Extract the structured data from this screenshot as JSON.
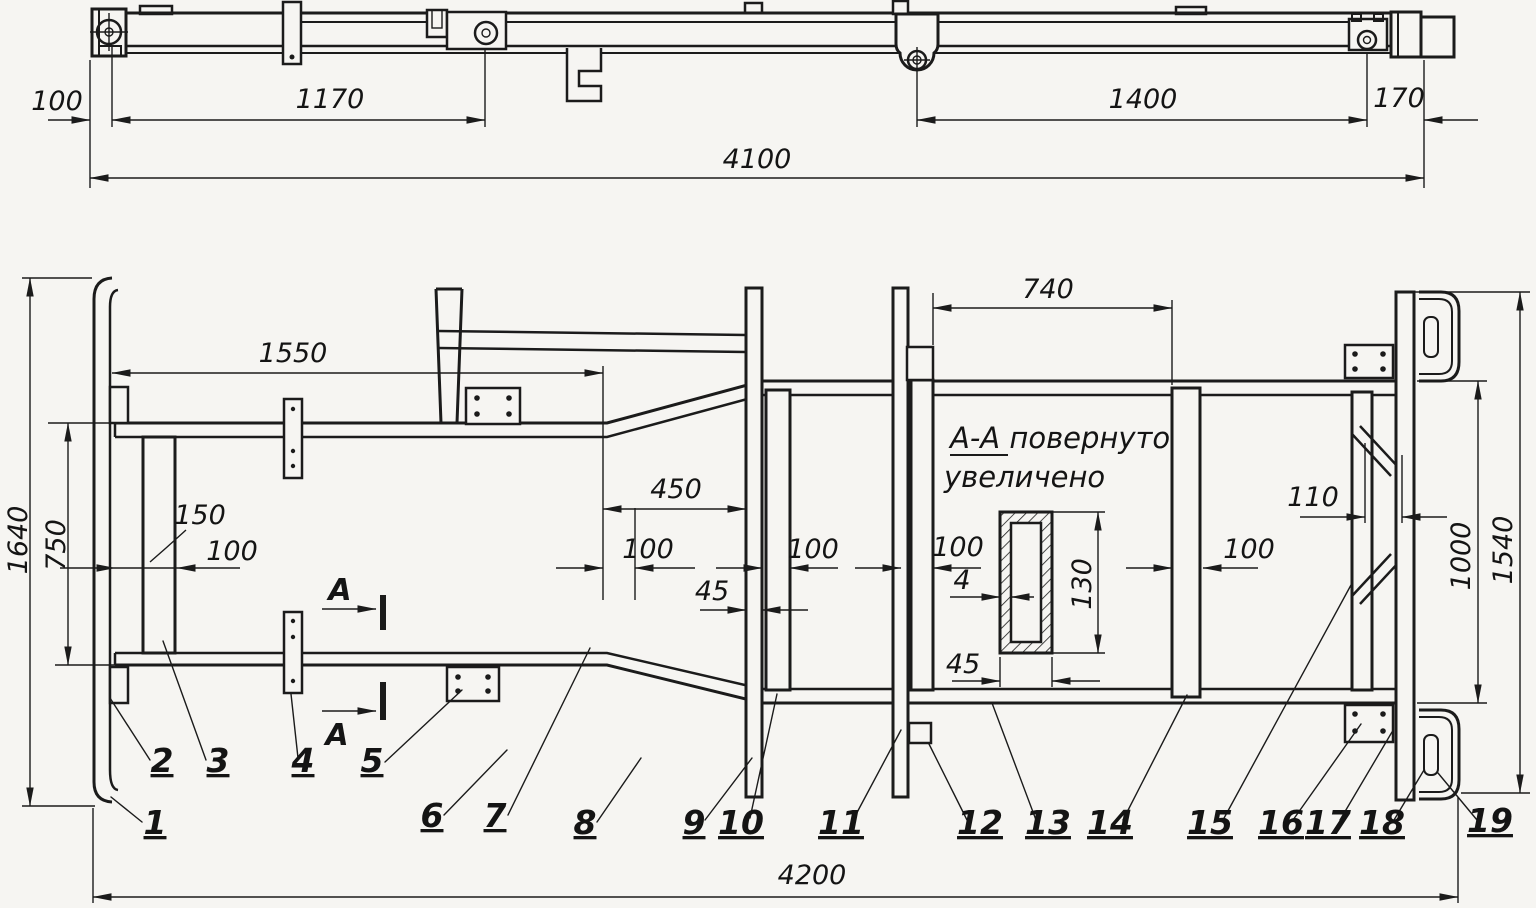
{
  "colors": {
    "paper": "#f6f5f2",
    "ink": "#1b1b1b"
  },
  "side_view": {
    "dims": {
      "offset_left": "100",
      "span_front": "1170",
      "span_rear": "1400",
      "offset_right": "170",
      "overall": "4100"
    }
  },
  "plan_view": {
    "dims": {
      "overall_width": "1640",
      "front_width": "750",
      "bumper_inset": "150",
      "member_100_1": "100",
      "front_length": "1550",
      "taper_length": "450",
      "member_100_2": "100",
      "member_100_3": "100",
      "member_100_4": "100",
      "member_100_5": "100",
      "member_45": "45",
      "platform_span": "740",
      "rear_gap": "110",
      "rear_width": "1000",
      "rear_overall": "1540",
      "overall_length": "4200"
    },
    "section_cut": {
      "upper": "А",
      "lower": "А"
    }
  },
  "section_detail": {
    "note1": "А-А повернуто",
    "note2": "увеличено",
    "dims": {
      "wall": "4",
      "height": "130",
      "width": "45"
    }
  },
  "callouts": [
    "1",
    "2",
    "3",
    "4",
    "5",
    "6",
    "7",
    "8",
    "9",
    "10",
    "11",
    "12",
    "13",
    "14",
    "15",
    "16",
    "17",
    "18",
    "19"
  ]
}
